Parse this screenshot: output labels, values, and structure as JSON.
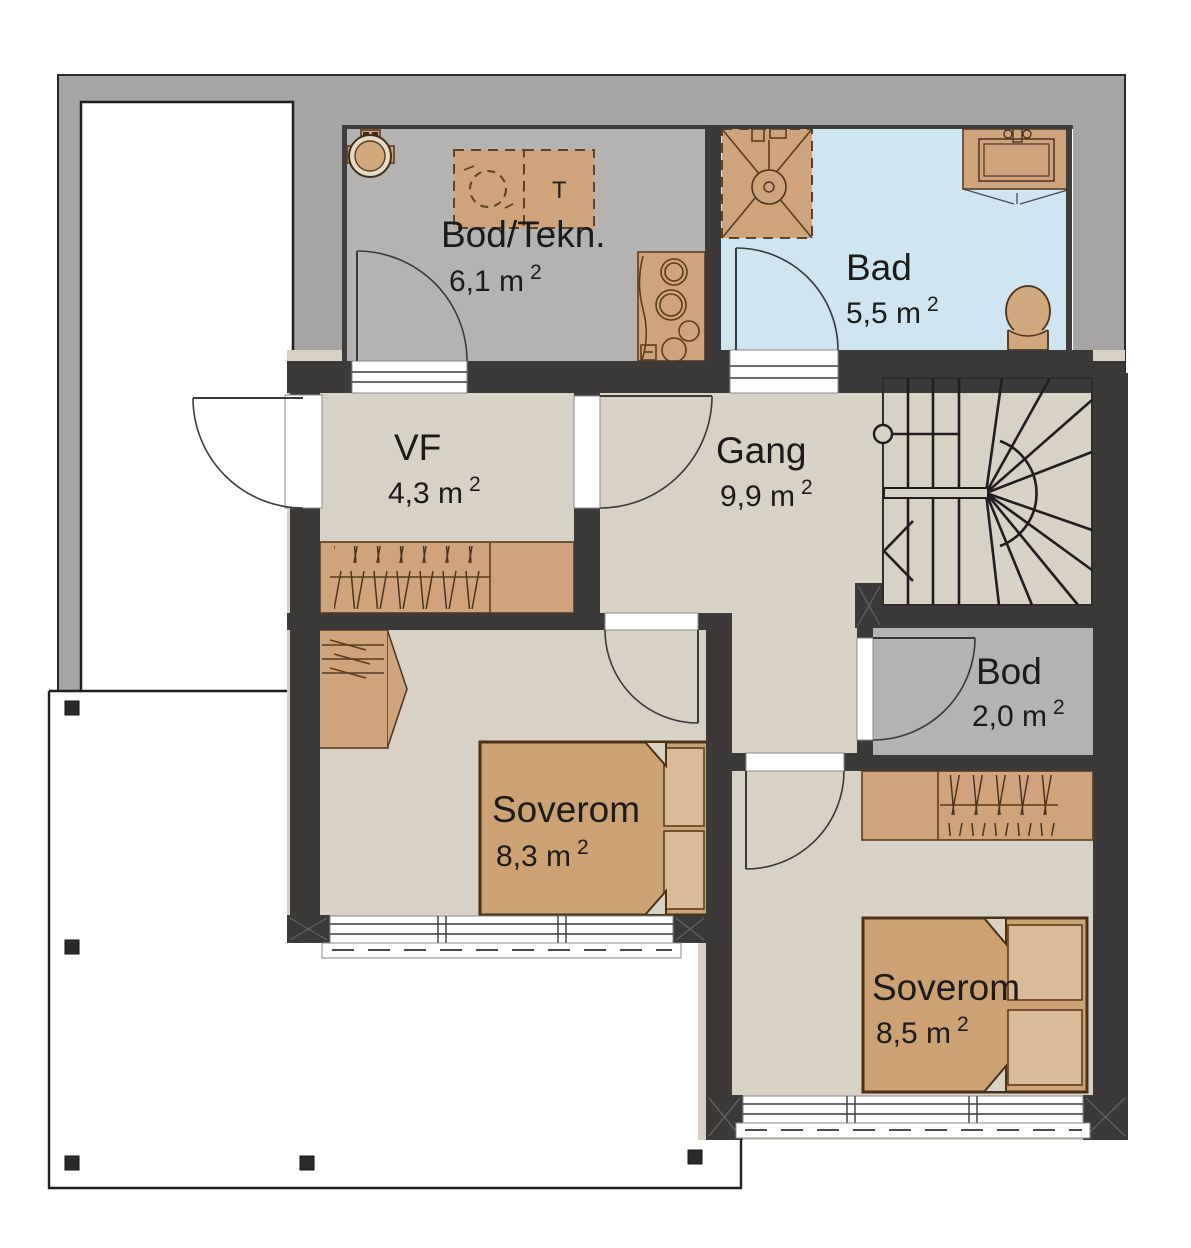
{
  "plan_title": "floor-plan",
  "rooms": [
    {
      "id": "bod-tekn",
      "name": "Bod/Tekn.",
      "area": "6,1 m",
      "sup": "2"
    },
    {
      "id": "bad",
      "name": "Bad",
      "area": "5,5 m",
      "sup": "2"
    },
    {
      "id": "vf",
      "name": "VF",
      "area": "4,3 m",
      "sup": "2"
    },
    {
      "id": "gang",
      "name": "Gang",
      "area": "9,9 m",
      "sup": "2"
    },
    {
      "id": "bod",
      "name": "Bod",
      "area": "2,0 m",
      "sup": "2"
    },
    {
      "id": "soverom-1",
      "name": "Soverom",
      "area": "8,3 m",
      "sup": "2"
    },
    {
      "id": "soverom-2",
      "name": "Soverom",
      "area": "8,5 m",
      "sup": "2"
    }
  ],
  "appliances": {
    "dryer_label": "T"
  },
  "colors": {
    "wall": "#3b3a39",
    "outer_band": "#a6a5a4",
    "floor_beige": "#d8d1c6",
    "floor_gray": "#b4b3b2",
    "floor_bath_blue": "#cfe5f2",
    "furniture_brown": "#cfa47c",
    "furniture_outline": "#5a3d1e",
    "text": "#1b1b1b"
  }
}
